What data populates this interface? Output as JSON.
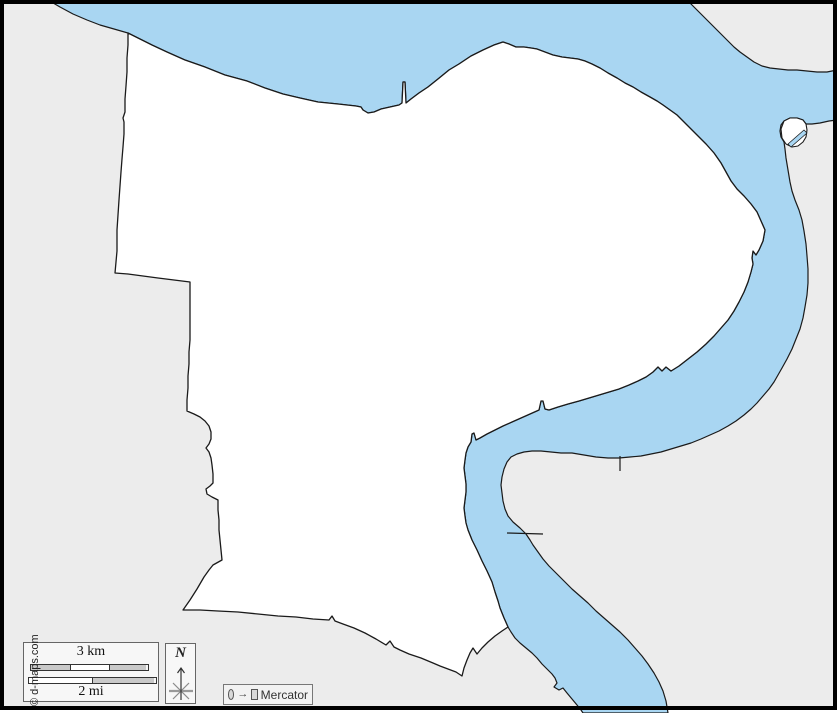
{
  "map": {
    "region_fill": "#ffffff",
    "land_fill": "#ececec",
    "water_fill": "#a9d6f2",
    "outline_color": "#1a1a1a"
  },
  "legend": {
    "scale_km_label": "3 km",
    "scale_mi_label": "2 mi",
    "bar_gray": "#c9c9c9",
    "bar_white": "#ffffff"
  },
  "compass": {
    "north_label": "N"
  },
  "projection": {
    "circle_icon": "circle",
    "arrow": "→",
    "square_icon": "square",
    "name": "Mercator"
  },
  "credit": {
    "text": "© d-maps.com"
  }
}
